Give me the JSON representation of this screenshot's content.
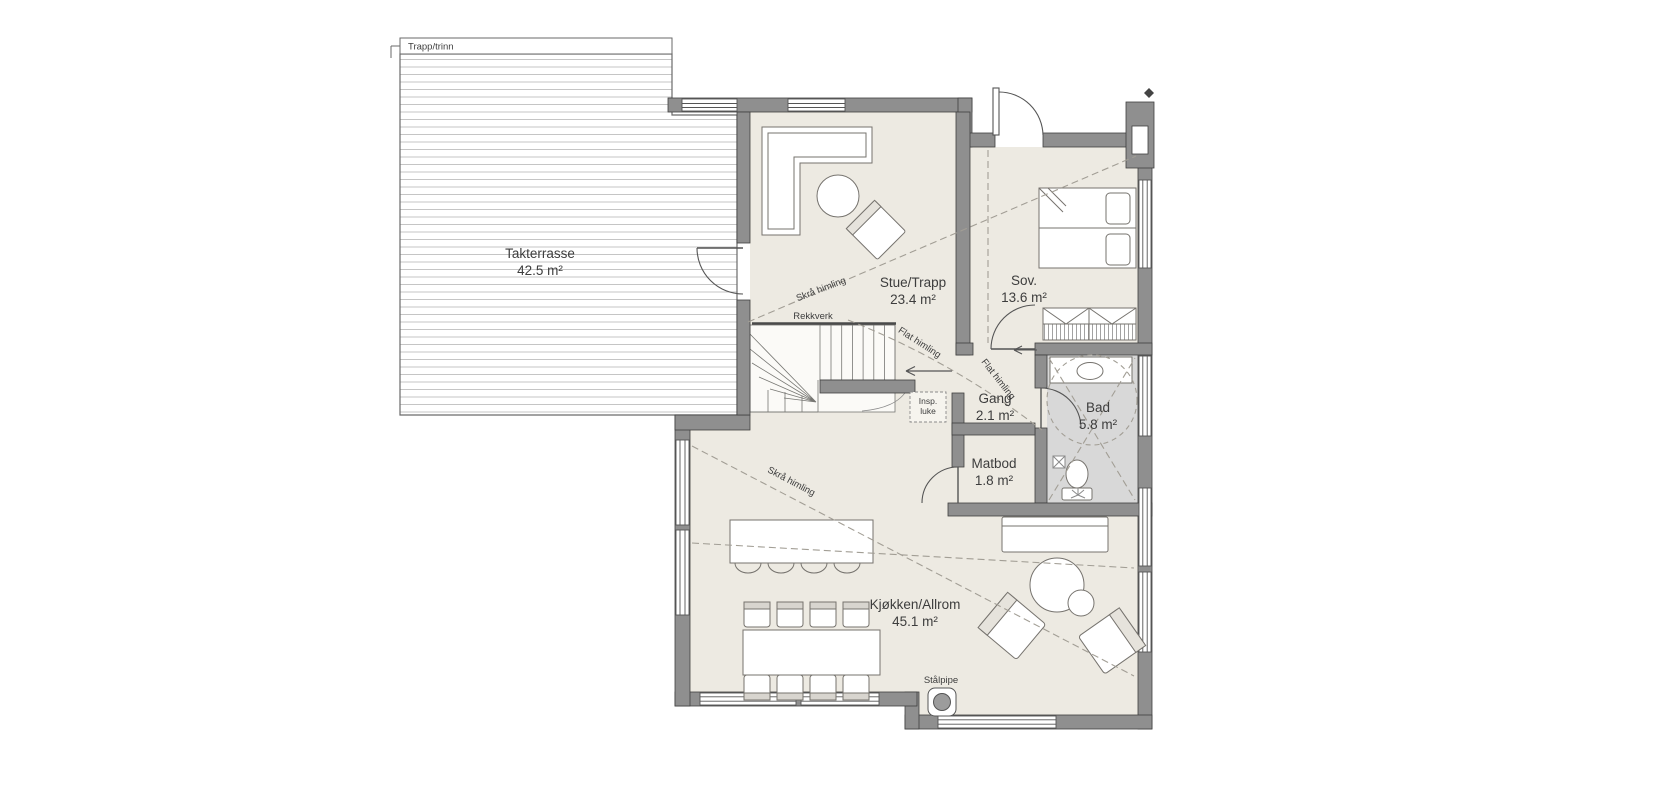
{
  "plan": {
    "type": "floorplan",
    "rooms": [
      {
        "name": "Takterrasse",
        "area": "42.5 m²"
      },
      {
        "name": "Stue/Trapp",
        "area": "23.4 m²"
      },
      {
        "name": "Sov.",
        "area": "13.6 m²"
      },
      {
        "name": "Gang",
        "area": "2.1 m²"
      },
      {
        "name": "Bad",
        "area": "5.8 m²"
      },
      {
        "name": "Matbod",
        "area": "1.8 m²"
      },
      {
        "name": "Kjøkken/Allrom",
        "area": "45.1 m²"
      }
    ],
    "annotations": {
      "terrace_stairs": "Trapp/trinn",
      "railing": "Rekkverk",
      "sloped_ceiling": "Skrå himling",
      "flat_ceiling": "Flat himling",
      "inspection_hatch_line1": "Insp.",
      "inspection_hatch_line2": "luke",
      "steel_chimney": "Stålpipe"
    },
    "colors": {
      "wall": "#8f8f8f",
      "floor": "#edeae2",
      "bath_floor": "#d8d8d8",
      "dashed_line": "#a29e95",
      "outline": "#3f3f3f"
    }
  }
}
